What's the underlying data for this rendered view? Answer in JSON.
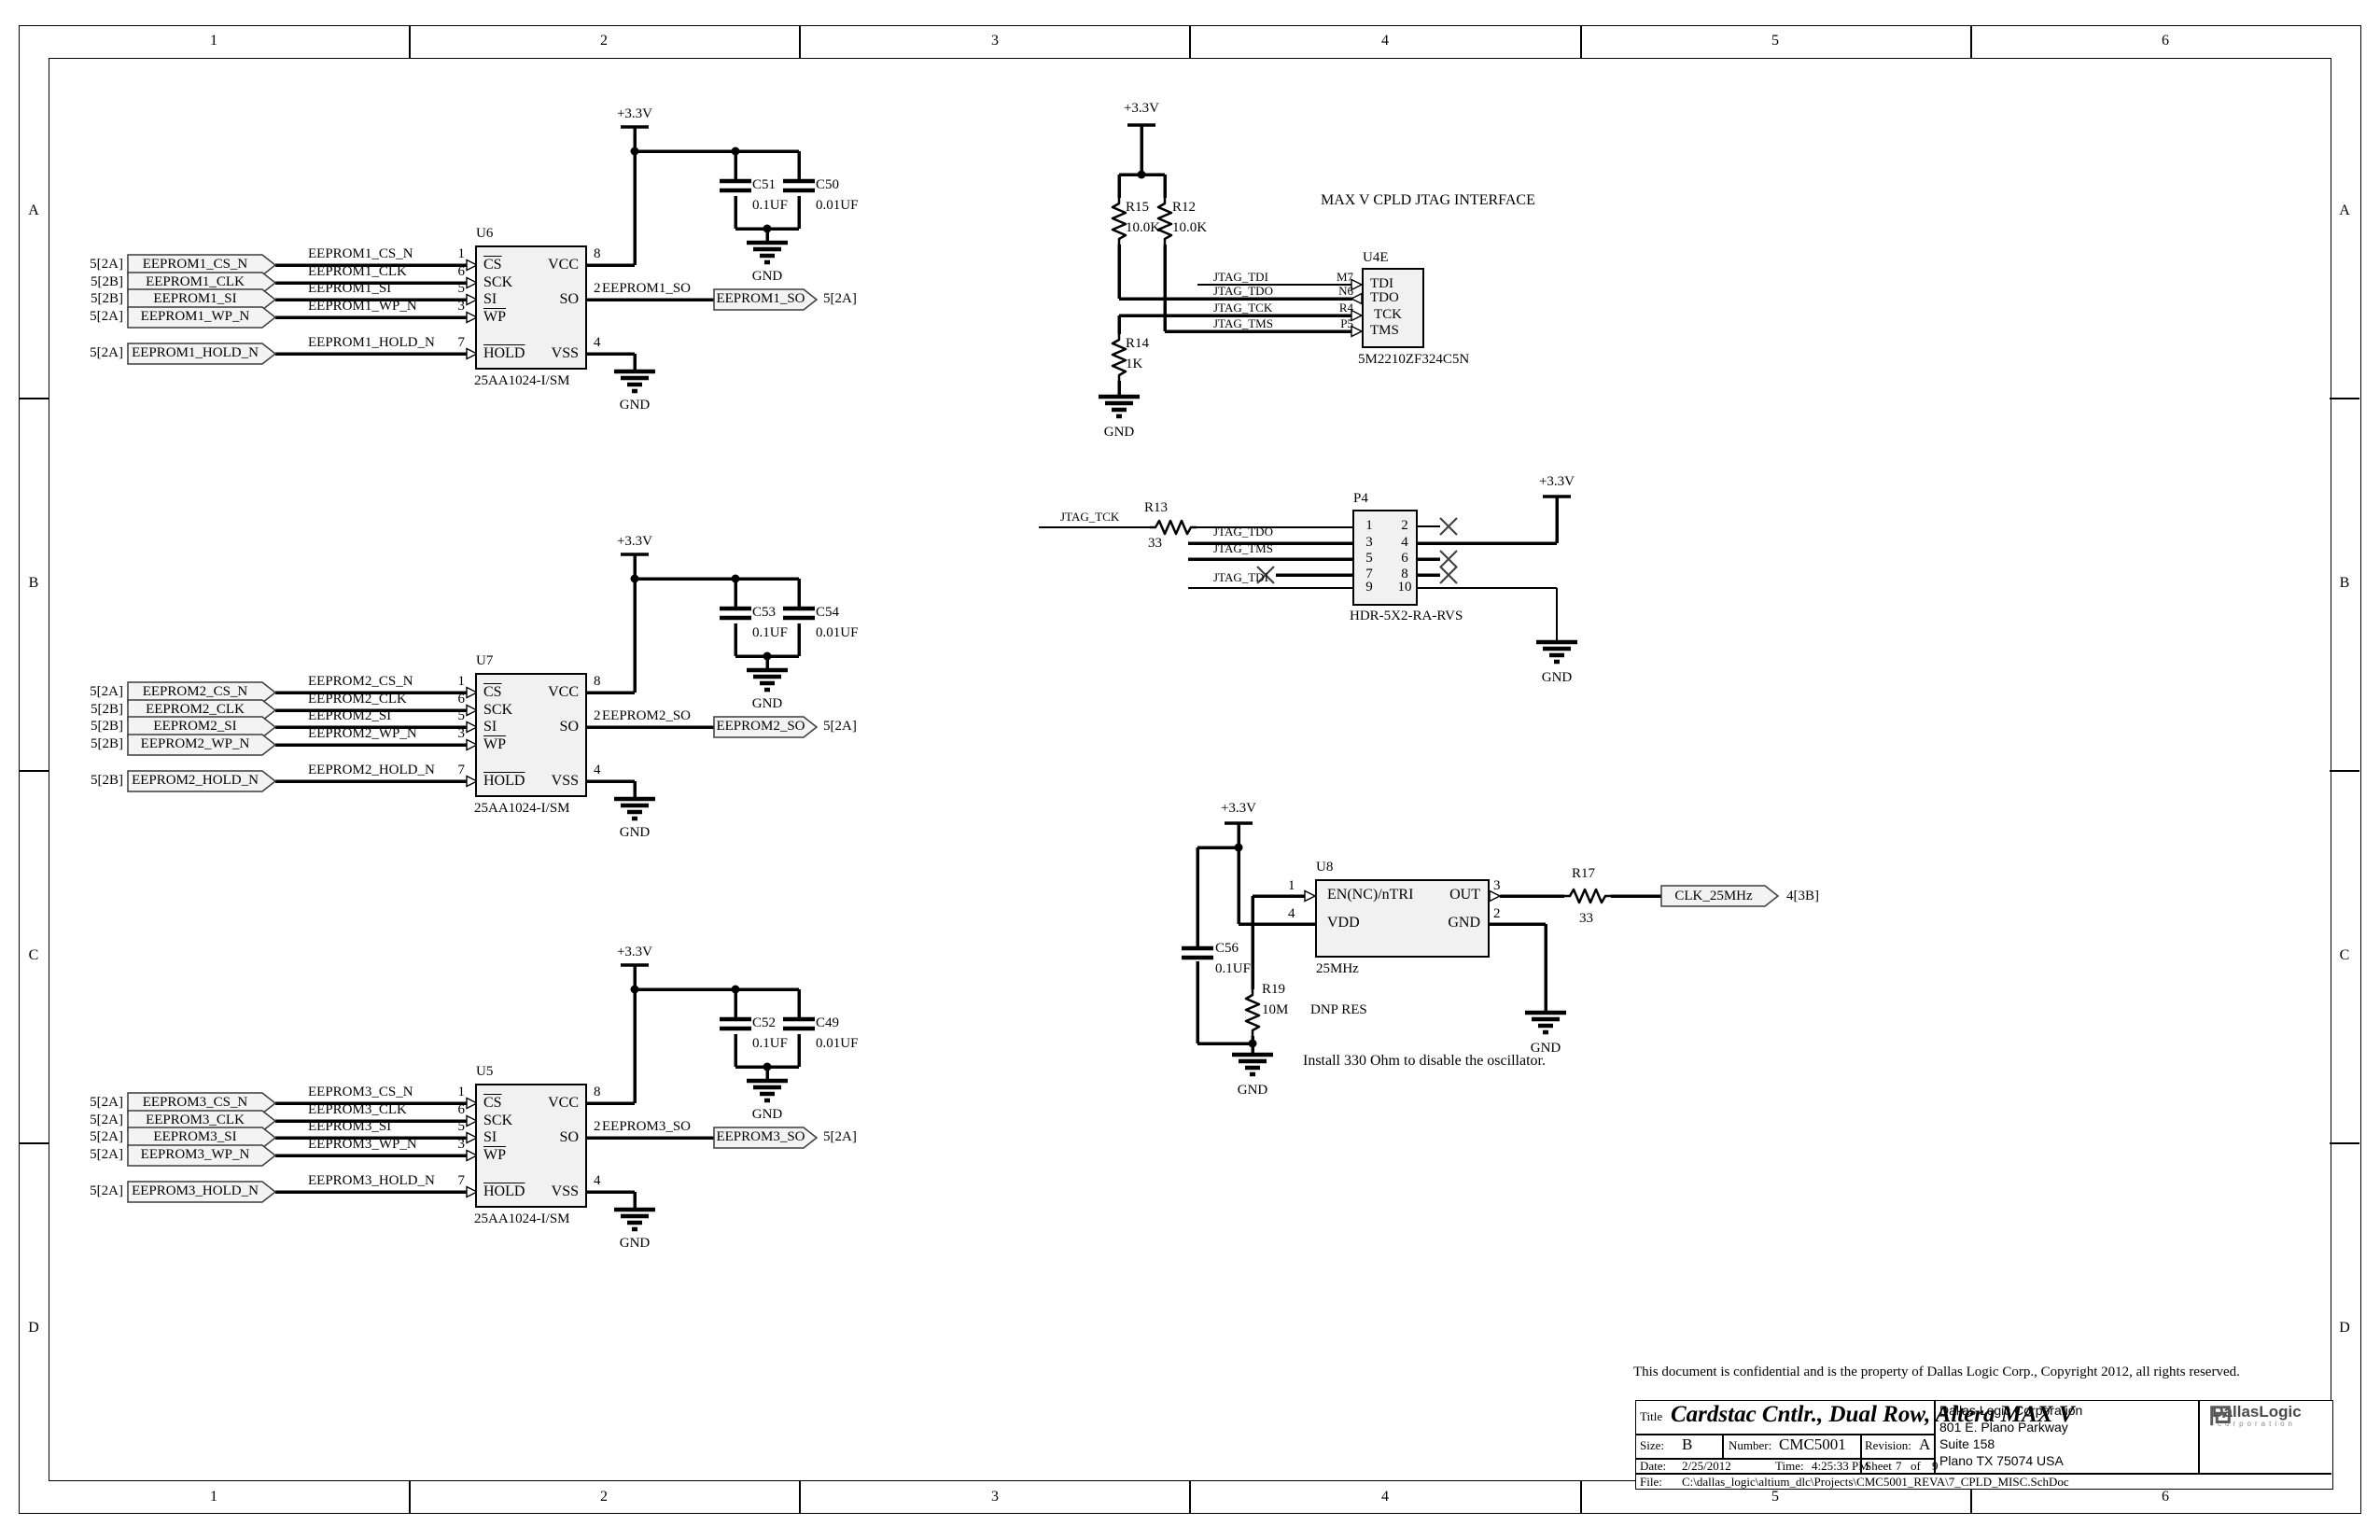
{
  "border": {
    "columns": [
      "1",
      "2",
      "3",
      "4",
      "5",
      "6"
    ],
    "rows": [
      "A",
      "B",
      "C",
      "D"
    ]
  },
  "power": {
    "v33": "+3.3V",
    "gnd": "GND"
  },
  "eeprom_chip": {
    "part": "25AA1024-I/SM",
    "pin_names": {
      "cs": "CS",
      "sck": "SCK",
      "si": "SI",
      "wp": "WP",
      "hold": "HOLD",
      "vcc": "VCC",
      "so": "SO",
      "vss": "VSS"
    },
    "pin_numbers": {
      "cs": "1",
      "sck": "6",
      "si": "5",
      "wp": "3",
      "hold": "7",
      "vcc": "8",
      "so": "2",
      "vss": "4"
    }
  },
  "eeprom_sections": [
    {
      "designator": "U6",
      "ports": [
        {
          "ref": "5[2A]",
          "name": "EEPROM1_CS_N"
        },
        {
          "ref": "5[2B]",
          "name": "EEPROM1_CLK"
        },
        {
          "ref": "5[2B]",
          "name": "EEPROM1_SI"
        },
        {
          "ref": "5[2A]",
          "name": "EEPROM1_WP_N"
        },
        {
          "ref": "5[2A]",
          "name": "EEPROM1_HOLD_N"
        }
      ],
      "so_port": {
        "name": "EEPROM1_SO",
        "ref": "5[2A]"
      },
      "caps": [
        {
          "d": "C51",
          "v": "0.1UF"
        },
        {
          "d": "C50",
          "v": "0.01UF"
        }
      ]
    },
    {
      "designator": "U7",
      "ports": [
        {
          "ref": "5[2A]",
          "name": "EEPROM2_CS_N"
        },
        {
          "ref": "5[2B]",
          "name": "EEPROM2_CLK"
        },
        {
          "ref": "5[2B]",
          "name": "EEPROM2_SI"
        },
        {
          "ref": "5[2B]",
          "name": "EEPROM2_WP_N"
        },
        {
          "ref": "5[2B]",
          "name": "EEPROM2_HOLD_N"
        }
      ],
      "so_port": {
        "name": "EEPROM2_SO",
        "ref": "5[2A]"
      },
      "caps": [
        {
          "d": "C53",
          "v": "0.1UF"
        },
        {
          "d": "C54",
          "v": "0.01UF"
        }
      ]
    },
    {
      "designator": "U5",
      "ports": [
        {
          "ref": "5[2A]",
          "name": "EEPROM3_CS_N"
        },
        {
          "ref": "5[2A]",
          "name": "EEPROM3_CLK"
        },
        {
          "ref": "5[2A]",
          "name": "EEPROM3_SI"
        },
        {
          "ref": "5[2A]",
          "name": "EEPROM3_WP_N"
        },
        {
          "ref": "5[2A]",
          "name": "EEPROM3_HOLD_N"
        }
      ],
      "so_port": {
        "name": "EEPROM3_SO",
        "ref": "5[2A]"
      },
      "caps": [
        {
          "d": "C52",
          "v": "0.1UF"
        },
        {
          "d": "C49",
          "v": "0.01UF"
        }
      ]
    }
  ],
  "jtag": {
    "title": "MAX V CPLD JTAG INTERFACE",
    "designator": "U4E",
    "part": "5M2210ZF324C5N",
    "r15": {
      "d": "R15",
      "v": "10.0K"
    },
    "r12": {
      "d": "R12",
      "v": "10.0K"
    },
    "r14": {
      "d": "R14",
      "v": "1K"
    },
    "pins": [
      {
        "net": "JTAG_TDI",
        "num": "M7",
        "name": "TDI"
      },
      {
        "net": "JTAG_TDO",
        "num": "N6",
        "name": "TDO"
      },
      {
        "net": "JTAG_TCK",
        "num": "R4",
        "name": "TCK"
      },
      {
        "net": "JTAG_TMS",
        "num": "P5",
        "name": "TMS"
      }
    ]
  },
  "p4": {
    "designator": "P4",
    "part": "HDR-5X2-RA-RVS",
    "r13": {
      "d": "R13",
      "v": "33"
    },
    "nets": {
      "tck": "JTAG_TCK",
      "tdo": "JTAG_TDO",
      "tms": "JTAG_TMS",
      "tdi": "JTAG_TDI"
    },
    "pin_numbers": [
      [
        "1",
        "2"
      ],
      [
        "3",
        "4"
      ],
      [
        "5",
        "6"
      ],
      [
        "7",
        "8"
      ],
      [
        "9",
        "10"
      ]
    ]
  },
  "oscillator": {
    "designator": "U8",
    "part": "25MHz",
    "pins": {
      "en": {
        "num": "1",
        "name": "EN(NC)/nTRI"
      },
      "vdd": {
        "num": "4",
        "name": "VDD"
      },
      "out": {
        "num": "3",
        "name": "OUT"
      },
      "gnd": {
        "num": "2",
        "name": "GND"
      }
    },
    "c56": {
      "d": "C56",
      "v": "0.1UF"
    },
    "r19": {
      "d": "R19",
      "v": "10M"
    },
    "r19_note": "DNP RES",
    "r17": {
      "d": "R17",
      "v": "33"
    },
    "out_port": {
      "name": "CLK_25MHz",
      "ref": "4[3B]"
    },
    "note": "Install 330 Ohm to disable the oscillator."
  },
  "copyright": "This document is confidential and is the property of Dallas Logic Corp.,  Copyright  2012, all rights reserved.",
  "title_block": {
    "title_label": "Title",
    "title": "Cardstac Cntlr., Dual Row, Altera MAX V",
    "size_label": "Size:",
    "size": "B",
    "number_label": "Number:",
    "number": "CMC5001",
    "revision_label": "Revision:",
    "revision": "A",
    "date_label": "Date:",
    "date": "2/25/2012",
    "time_label": "Time:",
    "time": "4:25:33 PM",
    "sheet_label": "Sheet",
    "sheet_number": "7",
    "sheet_of": "of",
    "sheet_total": "9",
    "file_label": "File:",
    "file_path": "C:\\dallas_logic\\altium_dlc\\Projects\\CMC5001_REVA\\7_CPLD_MISC.SchDoc",
    "company": {
      "name": "Dallas Logic Corporation",
      "address1": "801 E. Plano Parkway",
      "address2": "Suite 158",
      "address3": "Plano TX 75074 USA"
    },
    "logo": {
      "line1": "DallasLogic",
      "line2": "corporation"
    }
  }
}
